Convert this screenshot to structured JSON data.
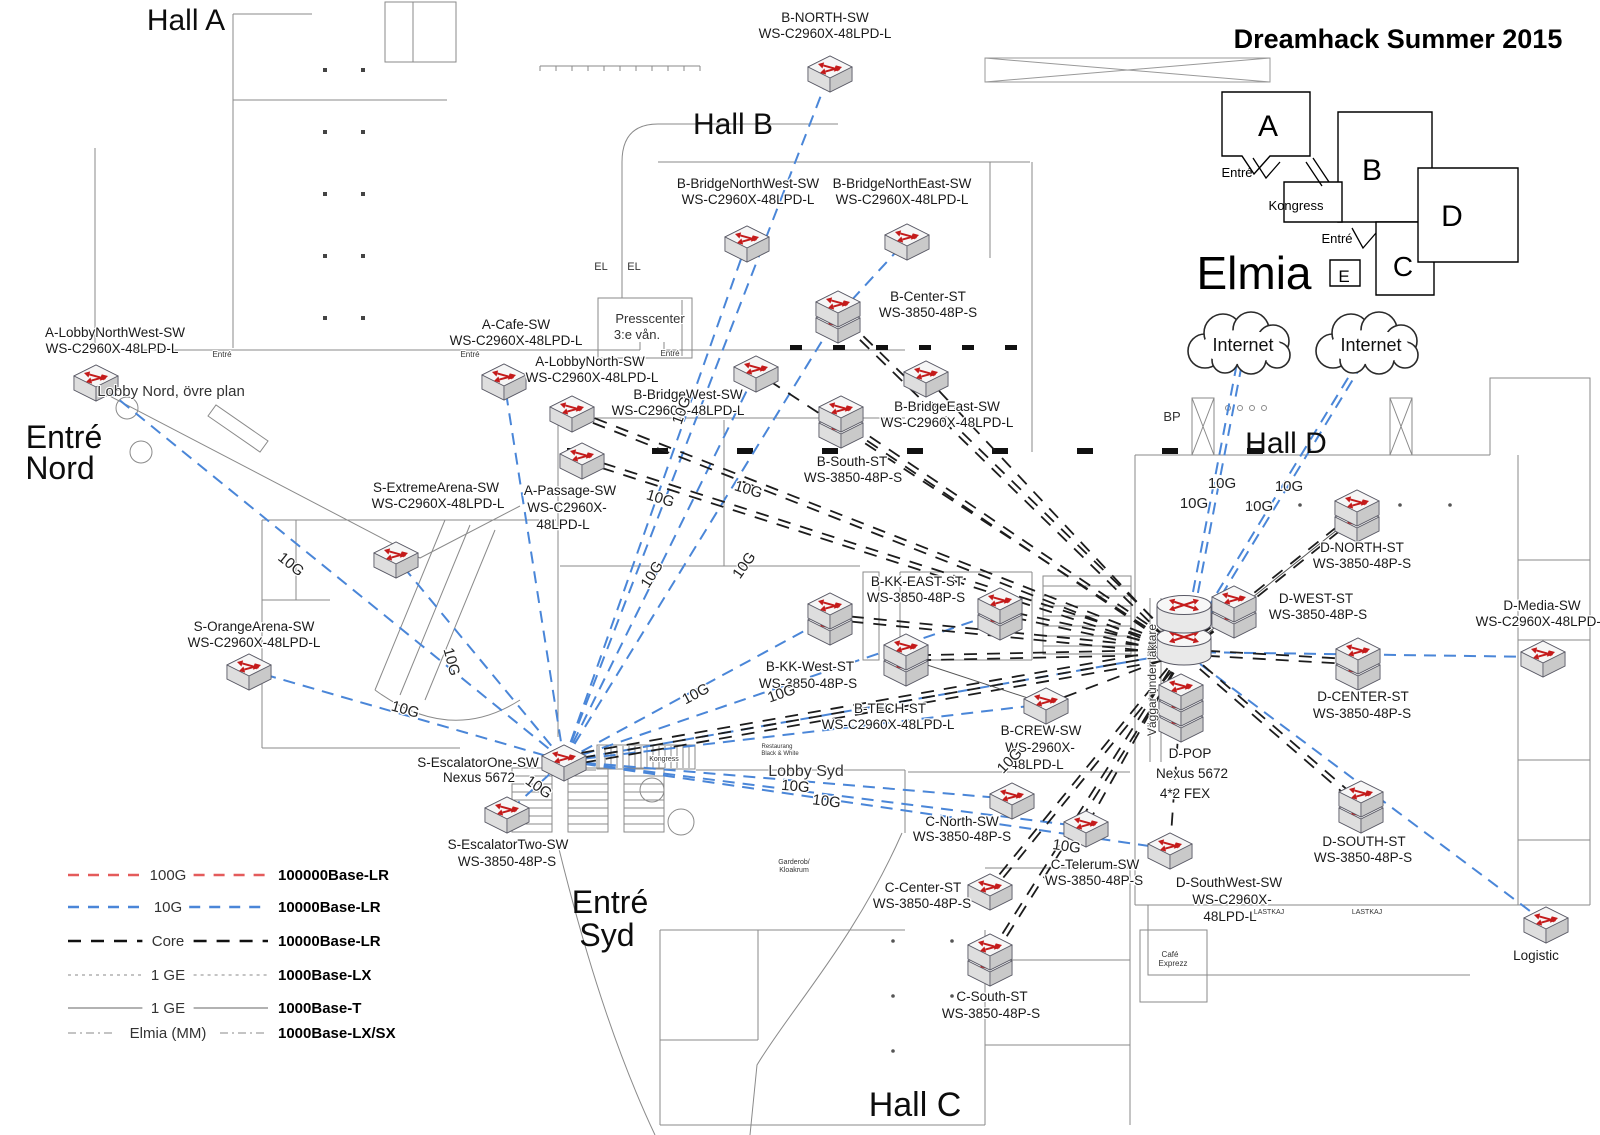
{
  "title": "Dreamhack Summer 2015",
  "elmia_label": "Elmia",
  "colors": {
    "g10": "#4a86d8",
    "core": "#1c1c1c",
    "g100": "#e45b5b",
    "thin": "#777777",
    "red_arrow": "#c41b1b"
  },
  "inset": {
    "halls": [
      {
        "t": "A",
        "x": 1268,
        "y": 136,
        "s": 30
      },
      {
        "t": "B",
        "x": 1372,
        "y": 180,
        "s": 30
      },
      {
        "t": "C",
        "x": 1403,
        "y": 276,
        "s": 28
      },
      {
        "t": "D",
        "x": 1452,
        "y": 226,
        "s": 30
      },
      {
        "t": "E",
        "x": 1344,
        "y": 282,
        "s": 17
      }
    ],
    "labels": [
      {
        "t": "Entré",
        "x": 1237,
        "y": 177,
        "s": 13
      },
      {
        "t": "Kongress",
        "x": 1296,
        "y": 210,
        "s": 13
      },
      {
        "t": "Entré",
        "x": 1337,
        "y": 243,
        "s": 13
      }
    ]
  },
  "hall_labels": [
    {
      "t": "Hall A",
      "x": 186,
      "y": 30,
      "s": 30
    },
    {
      "t": "Hall B",
      "x": 733,
      "y": 134,
      "s": 30
    },
    {
      "t": "Hall C",
      "x": 915,
      "y": 1116,
      "s": 34
    },
    {
      "t": "Hall D",
      "x": 1286,
      "y": 453,
      "s": 30
    },
    {
      "t": "Entré",
      "x": 64,
      "y": 448,
      "s": 32
    },
    {
      "t": "Nord",
      "x": 60,
      "y": 479,
      "s": 32
    },
    {
      "t": "Entré",
      "x": 610,
      "y": 913,
      "s": 32
    },
    {
      "t": "Syd",
      "x": 607,
      "y": 946,
      "s": 32
    }
  ],
  "plan_labels": [
    {
      "t": "Lobby Nord, övre plan",
      "x": 171,
      "y": 396,
      "s": 15
    },
    {
      "t": "Presscenter",
      "x": 650,
      "y": 323,
      "s": 13
    },
    {
      "t": "3:e vån.",
      "x": 637,
      "y": 339,
      "s": 13
    },
    {
      "t": "EL",
      "x": 601,
      "y": 270,
      "s": 11
    },
    {
      "t": "EL",
      "x": 634,
      "y": 270,
      "s": 11
    },
    {
      "t": "BP",
      "x": 1172,
      "y": 421,
      "s": 13
    },
    {
      "t": "Lobby Syd",
      "x": 806,
      "y": 776,
      "s": 16
    },
    {
      "t": "Kongress",
      "x": 664,
      "y": 761,
      "s": 7
    },
    {
      "t": "Garderob/",
      "x": 794,
      "y": 864,
      "s": 7
    },
    {
      "t": "Kloakrum",
      "x": 794,
      "y": 872,
      "s": 7
    },
    {
      "t": "Restaurang",
      "x": 777,
      "y": 748,
      "s": 6
    },
    {
      "t": "Black & White",
      "x": 780,
      "y": 755,
      "s": 6
    },
    {
      "t": "Café",
      "x": 1170,
      "y": 957,
      "s": 8
    },
    {
      "t": "Exprezz",
      "x": 1173,
      "y": 966,
      "s": 8
    },
    {
      "t": "LASTKAJ",
      "x": 1269,
      "y": 914,
      "s": 7
    },
    {
      "t": "LASTKAJ",
      "x": 1367,
      "y": 914,
      "s": 7
    },
    {
      "t": "Väggar under läktare",
      "x": 1156,
      "y": 680,
      "s": 12,
      "r": -90
    },
    {
      "t": "Entré",
      "x": 222,
      "y": 357,
      "s": 8
    },
    {
      "t": "Entré",
      "x": 470,
      "y": 357,
      "s": 8
    },
    {
      "t": "Entré",
      "x": 670,
      "y": 356,
      "s": 8
    }
  ],
  "nodes": [
    {
      "id": "A-LNW",
      "icon": "sw",
      "x": 96,
      "y": 381,
      "labels": [
        [
          "A-LobbyNorthWest-SW",
          115,
          337
        ],
        [
          "WS-C2960X-48LPD-L",
          112,
          353
        ]
      ]
    },
    {
      "id": "A-Cafe",
      "icon": "sw",
      "x": 504,
      "y": 380,
      "labels": [
        [
          "A-Cafe-SW",
          516,
          329
        ],
        [
          "WS-C2960X-48LPD-L",
          516,
          345
        ]
      ]
    },
    {
      "id": "A-LN",
      "icon": "sw",
      "x": 572,
      "y": 412,
      "labels": [
        [
          "A-LobbyNorth-SW",
          590,
          366
        ],
        [
          "WS-C2960X-48LPD-L",
          592,
          382
        ]
      ]
    },
    {
      "id": "A-Pass",
      "icon": "sw",
      "x": 582,
      "y": 459,
      "labels": [
        [
          "A-Passage-SW",
          570,
          495
        ],
        [
          "WS-C2960X-",
          567,
          512
        ],
        [
          "48LPD-L",
          563,
          529
        ]
      ]
    },
    {
      "id": "S-Ext",
      "icon": "sw",
      "x": 396,
      "y": 558,
      "labels": [
        [
          "S-ExtremeArena-SW",
          436,
          492
        ],
        [
          "WS-C2960X-48LPD-L",
          438,
          508
        ]
      ]
    },
    {
      "id": "S-Org",
      "icon": "sw",
      "x": 249,
      "y": 670,
      "labels": [
        [
          "S-OrangeArena-SW",
          254,
          631
        ],
        [
          "WS-C2960X-48LPD-L",
          254,
          647
        ]
      ]
    },
    {
      "id": "S-E1",
      "icon": "sw",
      "x": 564,
      "y": 761,
      "labels": [
        [
          "S-EscalatorOne-SW",
          478,
          767
        ],
        [
          "Nexus 5672",
          479,
          782
        ]
      ]
    },
    {
      "id": "S-E2",
      "icon": "sw",
      "x": 507,
      "y": 813,
      "labels": [
        [
          "S-EscalatorTwo-SW",
          508,
          849
        ],
        [
          "WS-3850-48P-S",
          507,
          866
        ]
      ]
    },
    {
      "id": "B-N",
      "icon": "sw",
      "x": 830,
      "y": 72,
      "labels": [
        [
          "B-NORTH-SW",
          825,
          22
        ],
        [
          "WS-C2960X-48LPD-L",
          825,
          38
        ]
      ]
    },
    {
      "id": "B-BNW",
      "icon": "sw",
      "x": 747,
      "y": 242,
      "labels": [
        [
          "B-BridgeNorthWest-SW",
          748,
          188
        ],
        [
          "WS-C2960X-48LPD-L",
          748,
          204
        ]
      ]
    },
    {
      "id": "B-BNE",
      "icon": "sw",
      "x": 907,
      "y": 240,
      "labels": [
        [
          "B-BridgeNorthEast-SW",
          902,
          188
        ],
        [
          "WS-C2960X-48LPD-L",
          902,
          204
        ]
      ]
    },
    {
      "id": "B-Ctr",
      "icon": "sw2",
      "x": 838,
      "y": 315,
      "labels": [
        [
          "B-Center-ST",
          928,
          301
        ],
        [
          "WS-3850-48P-S",
          928,
          317
        ]
      ]
    },
    {
      "id": "B-BW",
      "icon": "sw",
      "x": 756,
      "y": 372,
      "labels": [
        [
          "B-BridgeWest-SW",
          688,
          399
        ],
        [
          "WS-C2960X-48LPD-L",
          678,
          415
        ]
      ]
    },
    {
      "id": "B-BE",
      "icon": "sw",
      "x": 926,
      "y": 377,
      "labels": [
        [
          "B-BridgeEast-SW",
          947,
          411
        ],
        [
          "WS-C2960X-48LPD-L",
          947,
          427
        ]
      ]
    },
    {
      "id": "B-S",
      "icon": "sw2",
      "x": 841,
      "y": 420,
      "labels": [
        [
          "B-South-ST",
          852,
          466
        ],
        [
          "WS-3850-48P-S",
          853,
          482
        ]
      ]
    },
    {
      "id": "B-KKE",
      "icon": "sw2",
      "x": 1000,
      "y": 612,
      "labels": [
        [
          "B-KK-EAST-ST",
          917,
          586
        ],
        [
          "WS-3850-48P-S",
          916,
          602
        ]
      ]
    },
    {
      "id": "B-KKW",
      "icon": "sw2",
      "x": 830,
      "y": 617,
      "labels": [
        [
          "B-KK-West-ST",
          810,
          671
        ],
        [
          "WS-3850-48P-S",
          808,
          688
        ]
      ]
    },
    {
      "id": "B-T",
      "icon": "sw2",
      "x": 906,
      "y": 658,
      "labels": [
        [
          "B-TECH-ST",
          890,
          713
        ],
        [
          "WS-C2960X-48LPD-L",
          888,
          729
        ]
      ]
    },
    {
      "id": "B-Crew",
      "icon": "sw",
      "x": 1046,
      "y": 704,
      "labels": [
        [
          "B-CREW-SW",
          1041,
          735
        ],
        [
          "WS-2960X-",
          1040,
          752
        ],
        [
          "48LPD-L",
          1037,
          769
        ]
      ]
    },
    {
      "id": "C-N",
      "icon": "sw",
      "x": 1012,
      "y": 799,
      "labels": [
        [
          "C-North-SW",
          962,
          826
        ],
        [
          "WS-3850-48P-S",
          962,
          841
        ]
      ]
    },
    {
      "id": "C-Tel",
      "icon": "sw",
      "x": 1086,
      "y": 827,
      "labels": [
        [
          "C-Telerum-SW",
          1095,
          869
        ],
        [
          "WS-3850-48P-S",
          1094,
          885
        ]
      ]
    },
    {
      "id": "C-Ctr",
      "icon": "sw",
      "x": 990,
      "y": 890,
      "labels": [
        [
          "C-Center-ST",
          923,
          892
        ],
        [
          "WS-3850-48P-S",
          922,
          908
        ]
      ]
    },
    {
      "id": "C-S",
      "icon": "sw2",
      "x": 990,
      "y": 958,
      "labels": [
        [
          "C-South-ST",
          992,
          1001
        ],
        [
          "WS-3850-48P-S",
          991,
          1018
        ]
      ]
    },
    {
      "id": "D-POP",
      "icon": "pop",
      "x": 1184,
      "y": 652,
      "labels": [
        [
          "D-POP",
          1190,
          758
        ],
        [
          "Nexus 5672",
          1192,
          778
        ],
        [
          "4*2 FEX",
          1185,
          798
        ]
      ]
    },
    {
      "id": "D-N",
      "icon": "sw2",
      "x": 1357,
      "y": 514,
      "labels": [
        [
          "D-NORTH-ST",
          1362,
          552
        ],
        [
          "WS-3850-48P-S",
          1362,
          568
        ]
      ]
    },
    {
      "id": "D-W",
      "icon": "sw2",
      "x": 1234,
      "y": 610,
      "labels": [
        [
          "D-WEST-ST",
          1316,
          603
        ],
        [
          "WS-3850-48P-S",
          1318,
          619
        ]
      ]
    },
    {
      "id": "D-Ctr",
      "icon": "sw2",
      "x": 1358,
      "y": 662,
      "labels": [
        [
          "D-CENTER-ST",
          1363,
          701
        ],
        [
          "WS-3850-48P-S",
          1362,
          718
        ]
      ]
    },
    {
      "id": "D-Med",
      "icon": "sw",
      "x": 1543,
      "y": 657,
      "labels": [
        [
          "D-Media-SW",
          1542,
          610
        ],
        [
          "WS-C2960X-48LPD-L",
          1542,
          626
        ]
      ]
    },
    {
      "id": "D-S",
      "icon": "sw2",
      "x": 1361,
      "y": 805,
      "labels": [
        [
          "D-SOUTH-ST",
          1364,
          846
        ],
        [
          "WS-3850-48P-S",
          1363,
          862
        ]
      ]
    },
    {
      "id": "D-SW",
      "icon": "sw",
      "x": 1170,
      "y": 849,
      "labels": [
        [
          "D-SouthWest-SW",
          1229,
          887
        ],
        [
          "WS-C2960X-",
          1232,
          904
        ],
        [
          "48LPD-L",
          1230,
          921
        ]
      ]
    },
    {
      "id": "Log",
      "icon": "sw",
      "x": 1546,
      "y": 923,
      "labels": [
        [
          "Logistic",
          1536,
          960,
          15
        ]
      ]
    },
    {
      "id": "cloud1",
      "icon": "cloud",
      "x": 1243,
      "y": 345,
      "labels": [
        [
          "Internet",
          1243,
          351,
          18
        ]
      ]
    },
    {
      "id": "cloud2",
      "icon": "cloud",
      "x": 1371,
      "y": 345,
      "labels": [
        [
          "Internet",
          1371,
          351,
          18
        ]
      ]
    }
  ],
  "edges": [
    [
      "S-E1",
      "B-N",
      "g10",
      1
    ],
    [
      "S-E1",
      "B-BNW",
      "g10",
      1
    ],
    [
      "S-E1",
      "B-Ctr",
      "g10",
      1
    ],
    [
      "B-Ctr",
      "B-BNE",
      "g10",
      1
    ],
    [
      "S-E1",
      "A-Cafe",
      "g10",
      1
    ],
    [
      "S-E1",
      "A-LNW",
      "g10",
      1
    ],
    [
      "S-E1",
      "S-Ext",
      "g10",
      1
    ],
    [
      "S-E1",
      "S-Org",
      "g10",
      1
    ],
    [
      "S-E1",
      "S-E2",
      "g10",
      1
    ],
    [
      "S-E1",
      "B-BW",
      "g10",
      1
    ],
    [
      "S-E1",
      "B-KKW",
      "g10",
      1
    ],
    [
      "S-E1",
      "B-KKE",
      "g10",
      1
    ],
    [
      "S-E1",
      "B-Crew",
      "g10",
      1
    ],
    [
      "S-E1",
      "C-N",
      "g10",
      1
    ],
    [
      "S-E1",
      "C-Tel",
      "g10",
      1
    ],
    [
      "S-E1",
      "D-POP",
      "g10",
      1
    ],
    [
      "S-E1",
      "D-SW",
      "g10",
      1
    ],
    [
      "cloud1",
      "D-POP",
      "g10",
      2
    ],
    [
      "cloud2",
      "D-POP",
      "g10",
      2
    ],
    [
      "D-POP",
      "D-Med",
      "g10",
      1
    ],
    [
      "D-POP",
      "Log",
      "g10",
      1
    ],
    [
      "D-POP",
      "D-N",
      "core",
      2
    ],
    [
      "D-POP",
      "D-W",
      "core",
      2
    ],
    [
      "D-POP",
      "D-Ctr",
      "core",
      2
    ],
    [
      "D-POP",
      "D-S",
      "core",
      2
    ],
    [
      "D-POP",
      "D-SW",
      "core",
      1
    ],
    [
      "D-POP",
      "B-Ctr",
      "core",
      2
    ],
    [
      "D-POP",
      "B-S",
      "core",
      2
    ],
    [
      "D-POP",
      "B-KKE",
      "core",
      2
    ],
    [
      "D-POP",
      "B-KKW",
      "core",
      2
    ],
    [
      "D-POP",
      "B-T",
      "core",
      2
    ],
    [
      "D-POP",
      "B-Crew",
      "core",
      1
    ],
    [
      "D-POP",
      "C-Ctr",
      "core",
      2
    ],
    [
      "D-POP",
      "C-S",
      "core",
      2
    ],
    [
      "D-POP",
      "S-E1",
      "core",
      3
    ],
    [
      "D-POP",
      "A-LN",
      "core",
      2
    ],
    [
      "D-POP",
      "A-Pass",
      "core",
      2
    ],
    [
      "D-POP",
      "B-BW",
      "core",
      1
    ],
    [
      "D-POP",
      "B-BE",
      "core",
      1
    ],
    [
      "D-POP",
      "C-Tel",
      "core",
      1
    ],
    [
      "B-T",
      "B-Crew",
      "sol",
      1
    ],
    [
      "D-POP",
      "D-N",
      "sol",
      1
    ]
  ],
  "edge_labels": [
    {
      "t": "10G",
      "x": 288,
      "y": 568,
      "r": 39
    },
    {
      "t": "10G",
      "x": 404,
      "y": 714,
      "r": 16
    },
    {
      "t": "10G",
      "x": 536,
      "y": 791,
      "r": 35
    },
    {
      "t": "10G",
      "x": 447,
      "y": 663,
      "r": 75
    },
    {
      "t": "10G",
      "x": 686,
      "y": 412,
      "r": -70
    },
    {
      "t": "10G",
      "x": 659,
      "y": 503,
      "r": 17
    },
    {
      "t": "10G",
      "x": 747,
      "y": 494,
      "r": 17
    },
    {
      "t": "10G",
      "x": 656,
      "y": 577,
      "r": -58
    },
    {
      "t": "10G",
      "x": 748,
      "y": 568,
      "r": -55
    },
    {
      "t": "10G",
      "x": 698,
      "y": 698,
      "r": -28
    },
    {
      "t": "10G",
      "x": 783,
      "y": 698,
      "r": -19
    },
    {
      "t": "10G",
      "x": 795,
      "y": 791,
      "r": 5
    },
    {
      "t": "10G",
      "x": 826,
      "y": 806,
      "r": 7
    },
    {
      "t": "10G",
      "x": 1066,
      "y": 851,
      "r": 8
    },
    {
      "t": "10G",
      "x": 1013,
      "y": 764,
      "r": -46
    },
    {
      "t": "10G",
      "x": 1222,
      "y": 488,
      "r": 0
    },
    {
      "t": "10G",
      "x": 1194,
      "y": 508,
      "r": 0
    },
    {
      "t": "10G",
      "x": 1289,
      "y": 491,
      "r": 0
    },
    {
      "t": "10G",
      "x": 1259,
      "y": 511,
      "r": 0
    }
  ],
  "legend": {
    "rows": [
      {
        "line": "100G",
        "right": "100000Base-LR",
        "kind": "g100"
      },
      {
        "line": "10G",
        "right": "10000Base-LR",
        "kind": "g10"
      },
      {
        "line": "Core",
        "right": "10000Base-LR",
        "kind": "core"
      },
      {
        "line": "1 GE",
        "right": "1000Base-LX",
        "kind": "ge"
      },
      {
        "line": "1 GE",
        "right": "1000Base-T",
        "kind": "sol"
      },
      {
        "line": "Elmia (MM)",
        "right": "1000Base-LX/SX",
        "kind": "mm"
      }
    ]
  }
}
